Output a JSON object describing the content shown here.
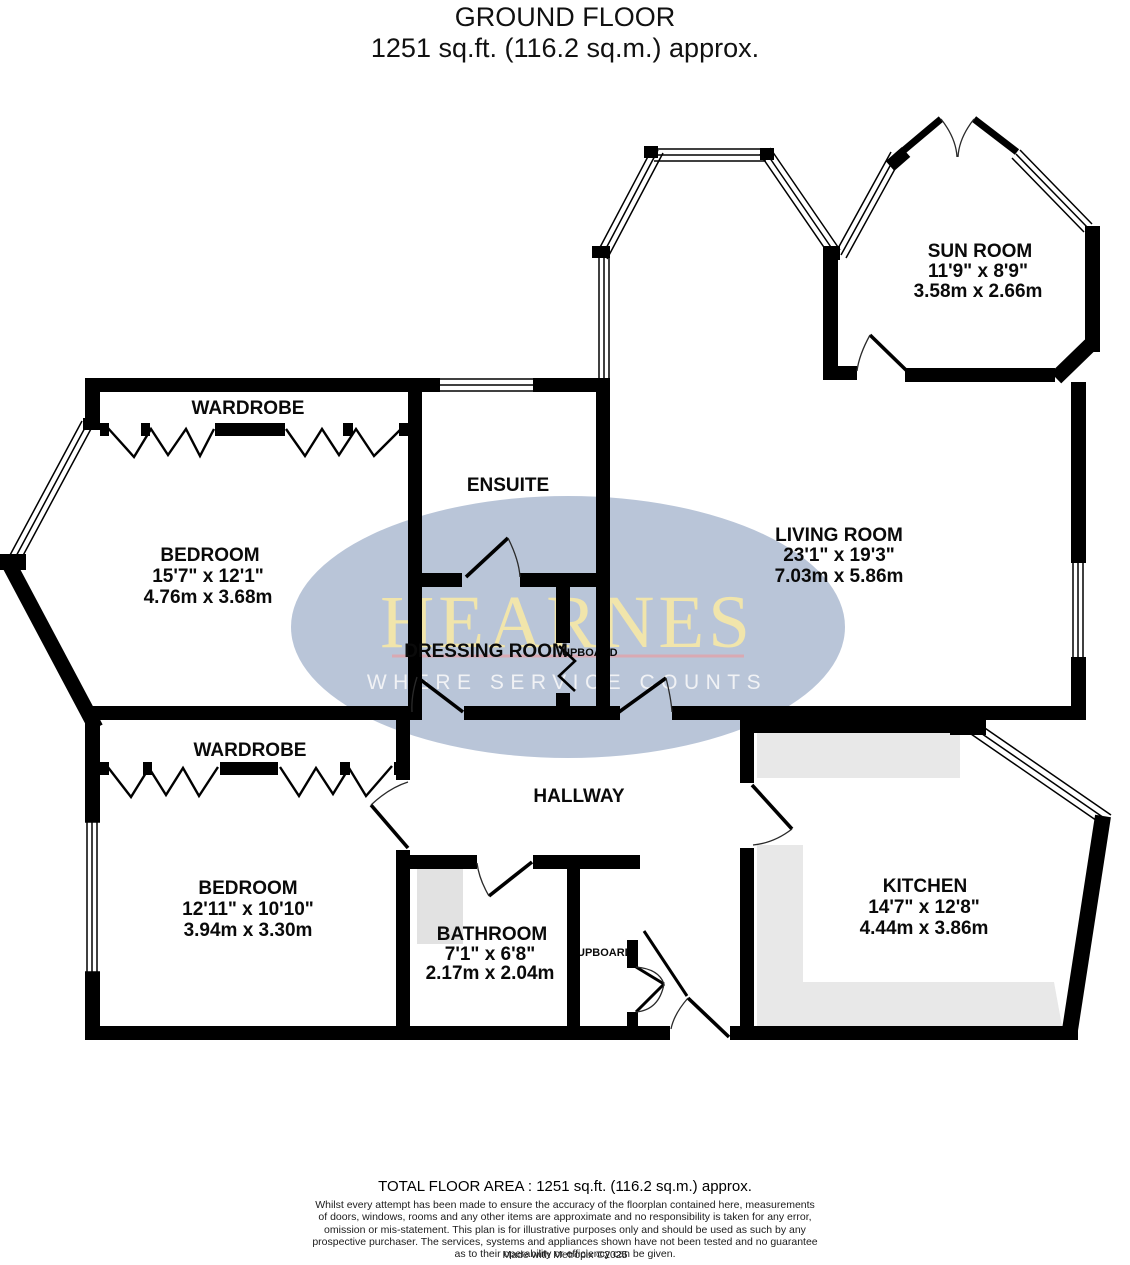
{
  "title": {
    "line1": "GROUND FLOOR",
    "line2": "1251 sq.ft. (116.2 sq.m.) approx."
  },
  "watermark": {
    "brand": "HEARNES",
    "tagline": "WHERE SERVICE COUNTS",
    "ellipse_color": "#b5c2d6",
    "brand_color": "#f1e5ab",
    "underline_color": "#d9a9b2"
  },
  "plan": {
    "wall_color": "#000000",
    "counter_color": "#e8e8e8",
    "shower_color": "#e2e2e2"
  },
  "rooms": {
    "sun_room": {
      "name": "SUN ROOM",
      "imperial": "11'9\"  x 8'9\"",
      "metric": "3.58m  x 2.66m"
    },
    "living_room": {
      "name": "LIVING ROOM",
      "imperial": "23'1\"  x 19'3\"",
      "metric": "7.03m  x 5.86m"
    },
    "bedroom1": {
      "name": "BEDROOM",
      "imperial": "15'7\"  x 12'1\"",
      "metric": "4.76m  x 3.68m"
    },
    "bedroom2": {
      "name": "BEDROOM",
      "imperial": "12'11\"  x 10'10\"",
      "metric": "3.94m  x 3.30m"
    },
    "kitchen": {
      "name": "KITCHEN",
      "imperial": "14'7\"  x 12'8\"",
      "metric": "4.44m  x 3.86m"
    },
    "bathroom": {
      "name": "BATHROOM",
      "imperial": "7'1\"  x 6'8\"",
      "metric": "2.17m  x 2.04m"
    },
    "ensuite": {
      "name": "ENSUITE"
    },
    "dressing_room": {
      "name": "DRESSING ROOM"
    },
    "hallway": {
      "name": "HALLWAY"
    },
    "wardrobe1": {
      "name": "WARDROBE"
    },
    "wardrobe2": {
      "name": "WARDROBE"
    },
    "cupboard1": {
      "name": "UPBOARD"
    },
    "cupboard2": {
      "name": "UPBOARD"
    }
  },
  "footer": {
    "total_area": "TOTAL FLOOR AREA : 1251 sq.ft. (116.2 sq.m.) approx.",
    "disclaimer_lines": [
      "Whilst every attempt has been made to ensure the accuracy of the floorplan contained here, measurements",
      "of doors, windows, rooms and any other items are approximate and no responsibility is taken for any error,",
      "omission or mis-statement. This plan is for illustrative purposes only and should be used as such by any",
      "prospective purchaser. The services, systems and appliances shown have not been tested and no guarantee",
      "as to their operability or efficiency can be given."
    ],
    "credit": "Made with Metropix ©2025"
  }
}
